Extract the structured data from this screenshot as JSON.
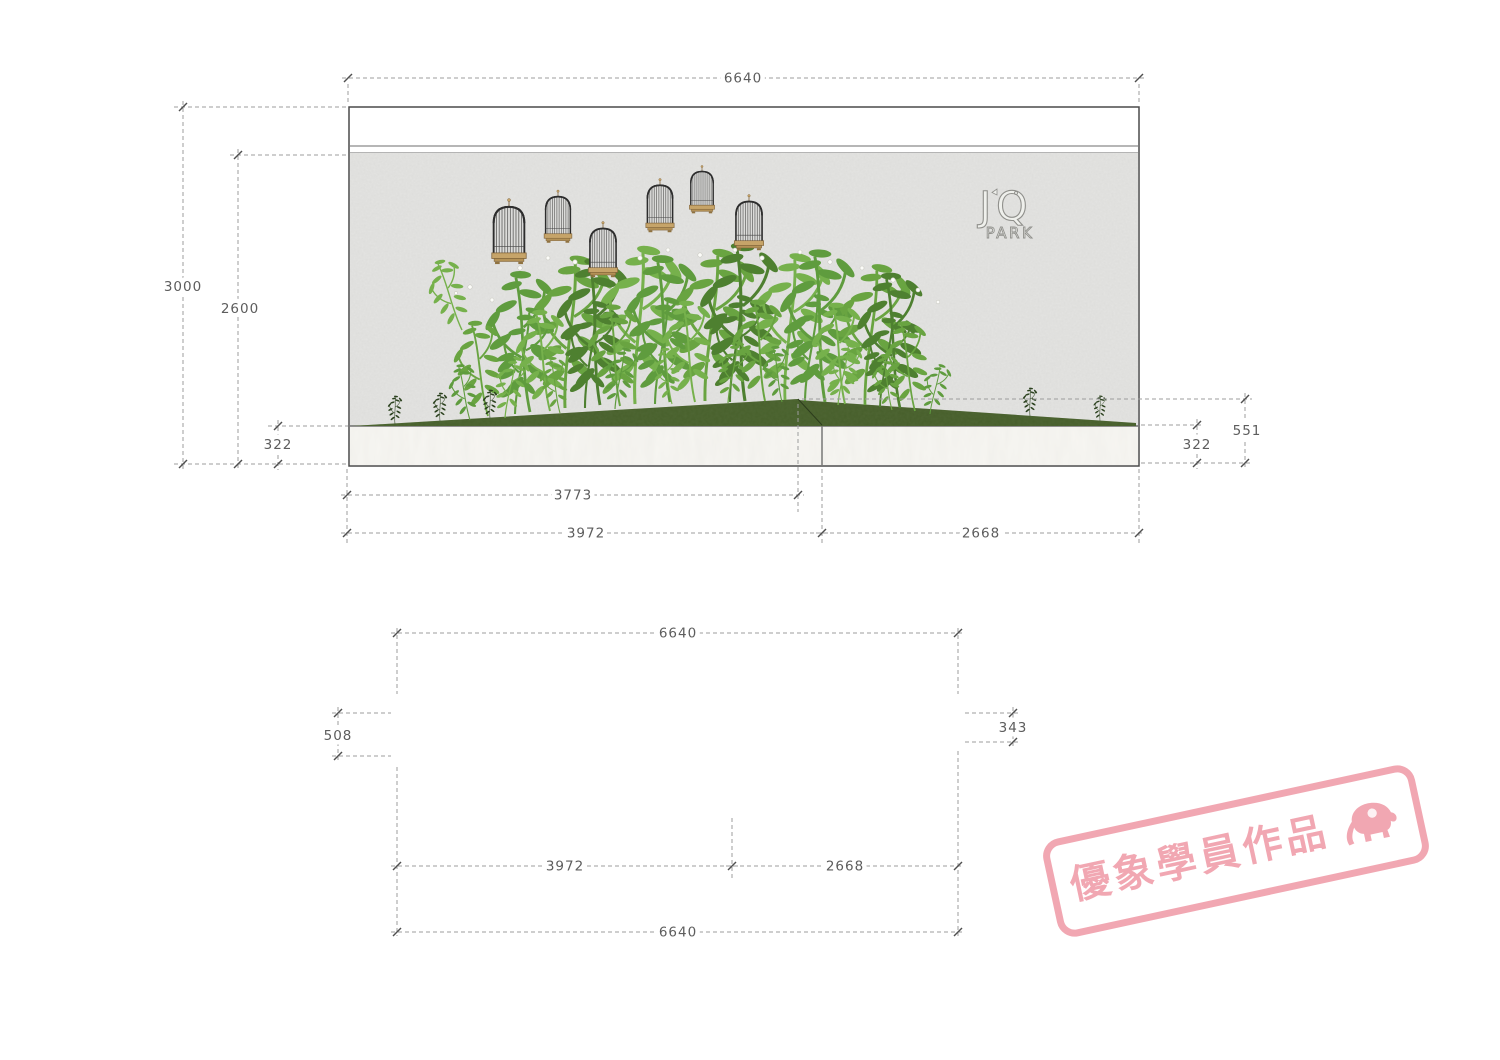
{
  "elevation": {
    "dims": {
      "total_width": "6640",
      "total_height": "3000",
      "wall_height": "2600",
      "base_height_left": "322",
      "mound_peak_height": "551",
      "base_height_right": "322",
      "planter_width": "3773",
      "left_bay_width": "3972",
      "right_bay_width": "2668"
    },
    "logo": {
      "line1": "JQ",
      "line2": "PARK"
    }
  },
  "plan": {
    "dims": {
      "total_width_top": "6640",
      "depth_left": "508",
      "depth_right": "343",
      "left_bay_width": "3972",
      "right_bay_width": "2668",
      "total_width_bottom": "6640"
    }
  },
  "stamp": {
    "text": "優象學員作品"
  },
  "colors": {
    "stamp_pink": "#f1a3ae",
    "wall_gray": "#e4e4e2",
    "marble_white": "#f7f6f2",
    "mound_green": "#47602b",
    "cage_base_tan": "#c6a469",
    "plant_green": "#5f9c3e"
  }
}
